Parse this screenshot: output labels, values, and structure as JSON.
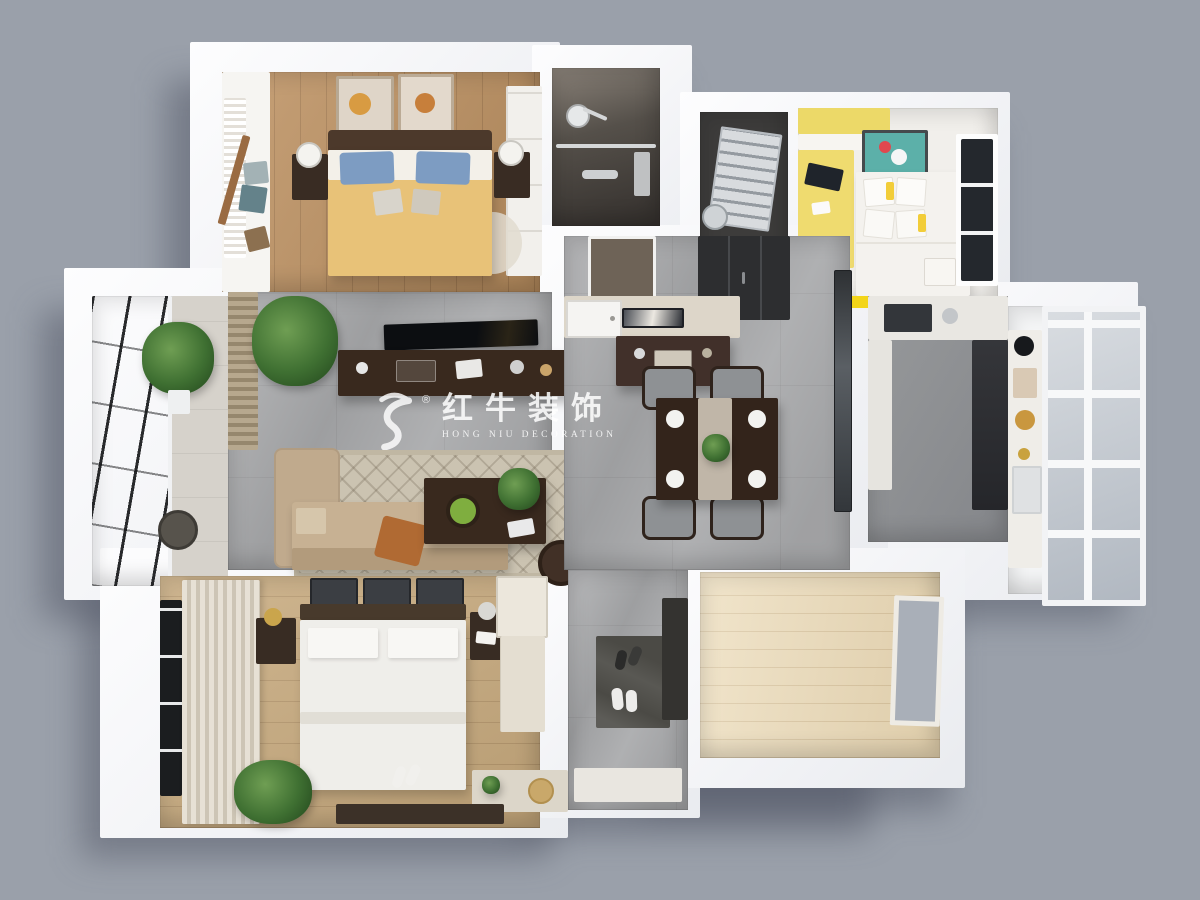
{
  "watermark": {
    "brand_cn": "红牛装饰",
    "brand_en": "HONG NIU DECORATION",
    "registered": "®",
    "color": "#ffffff"
  },
  "palette": {
    "background": "#9aa0aa",
    "wall_white": "#f3f4f6",
    "floor_wood_bedroom": "#bd9161",
    "floor_wood_master": "#c7a97c",
    "floor_wood_light": "#ecdcba",
    "floor_marble_gray": "#a6a7a9",
    "floor_bathroom_dark": "#4a453f",
    "furniture_dark_wood": "#39291e",
    "sofa_beige": "#c7b193",
    "bed_duvet_yellow": "#e8c278",
    "pillow_blue": "#7d9cc2",
    "kids_accent_yellow": "#f3d519",
    "kids_art_teal": "#5cb0a9",
    "throw_orange": "#b06a33",
    "window_frame_black": "#1b1d1f"
  }
}
